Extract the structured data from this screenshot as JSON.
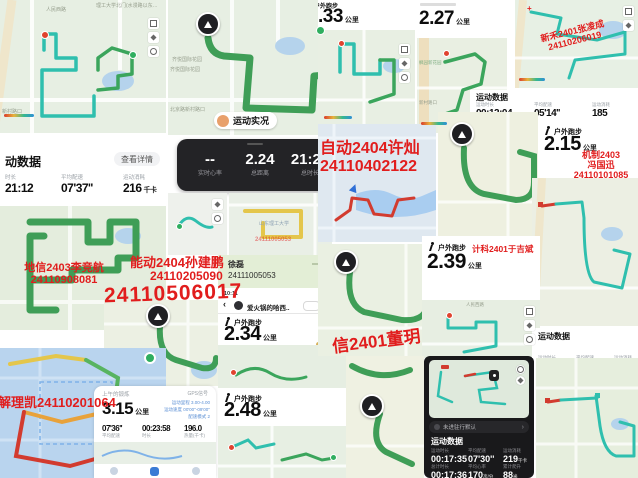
{
  "overlay_red": {
    "zidong1": "自动2404许灿",
    "zidong2": "24110402122",
    "nengdong1": "能动2404孙建鹏",
    "nengdong2": "24110205090",
    "nengdong_big": "24110506017",
    "dixin1": "地信2403李竞航",
    "dixin2": "24110908081",
    "jieli": "解理凯24110201064",
    "xinhe1": "新禾2401张凌成",
    "xinhe2": "24110206019",
    "jizhi1": "机制2403",
    "jizhi2": "冯国迅",
    "jizhi3": "24110101085",
    "jike": "计科2401于吉斌",
    "dianxin": "信2401董玥",
    "yellowmap_id": "24111005053"
  },
  "banner": {
    "name": "徐磊",
    "id": "24111005053"
  },
  "live_pill": "运动实况",
  "dark_live": {
    "s": [
      {
        "v": "--",
        "l": "实时心率"
      },
      {
        "v": "2.24",
        "l": "总距离"
      },
      {
        "v": "21:24",
        "l": "总时长"
      }
    ]
  },
  "data_card": {
    "title": "动数据",
    "btn": "查看详情",
    "s": [
      {
        "l": "时长",
        "v": "21:12"
      },
      {
        "l": "平均配速",
        "v": "07'37''"
      },
      {
        "l": "运动消耗",
        "v": "216",
        "u": "千卡"
      }
    ]
  },
  "strip1": {
    "title": "运动数据",
    "s": [
      {
        "l": "运动时长",
        "v": "00:12:04"
      },
      {
        "l": "平均配速",
        "v": "05'14''"
      },
      {
        "l": "运动消耗",
        "v": "185"
      }
    ]
  },
  "strip2": {
    "title": "运动数据",
    "labels": [
      "运动时长",
      "平均配速",
      "运动消耗"
    ]
  },
  "dark_card": {
    "banner": "未进驻行默认",
    "chev": "›",
    "title": "运动数据",
    "r1": [
      {
        "l": "运动时长",
        "v": "00:17:35"
      },
      {
        "l": "平均配速",
        "v": "07'30''"
      },
      {
        "l": "运动消耗",
        "v": "219",
        "u": "千卡"
      }
    ],
    "r2": [
      {
        "l": "总计时长",
        "v": "00:17:36"
      },
      {
        "l": "平均心率",
        "v": "170",
        "u": "次/分"
      },
      {
        "l": "累计爬升",
        "v": "88",
        "u": "米"
      }
    ]
  },
  "keep": {
    "header": "上午的锻炼",
    "gps": "GPS信号",
    "v": "3.15",
    "u": "公里",
    "side": [
      "运动里程 3.00-4.00",
      "运动速度 00'00''-09'00''",
      "配速模式 2"
    ],
    "s": [
      {
        "v": "07'36''",
        "l": "平均配速"
      },
      {
        "v": "00:23:58",
        "l": "时长"
      },
      {
        "v": "196.0",
        "l": "热量(千卡)"
      }
    ]
  },
  "runs": {
    "r33": {
      "h": "户外跑步",
      "v": ".33",
      "u": "公里"
    },
    "r227": {
      "v": "2.27",
      "u": "公里"
    },
    "r215": {
      "h": "户外跑步",
      "v": "2.15",
      "u": "公里"
    },
    "r239": {
      "h": "户外跑步",
      "v": "2.39",
      "u": "公里"
    },
    "r234": {
      "h": "户外跑步",
      "v": "2.34",
      "u": "公里",
      "badge": "PB"
    },
    "r248": {
      "h": "户外跑步",
      "v": "2.48",
      "u": "公里"
    }
  },
  "chat": {
    "time": "10:11",
    "back": "‹",
    "title": "爱火锅的哈西.."
  },
  "maps": {
    "renmin": "人民西路",
    "gate": "理工大学北门(水漫路以东…",
    "xincun": "新村路口",
    "qiyue": "齐悦国际花园",
    "beijing": "北京路新村路口",
    "sdut": "山东理工大学",
    "fengyuan": "枫园新花园"
  }
}
